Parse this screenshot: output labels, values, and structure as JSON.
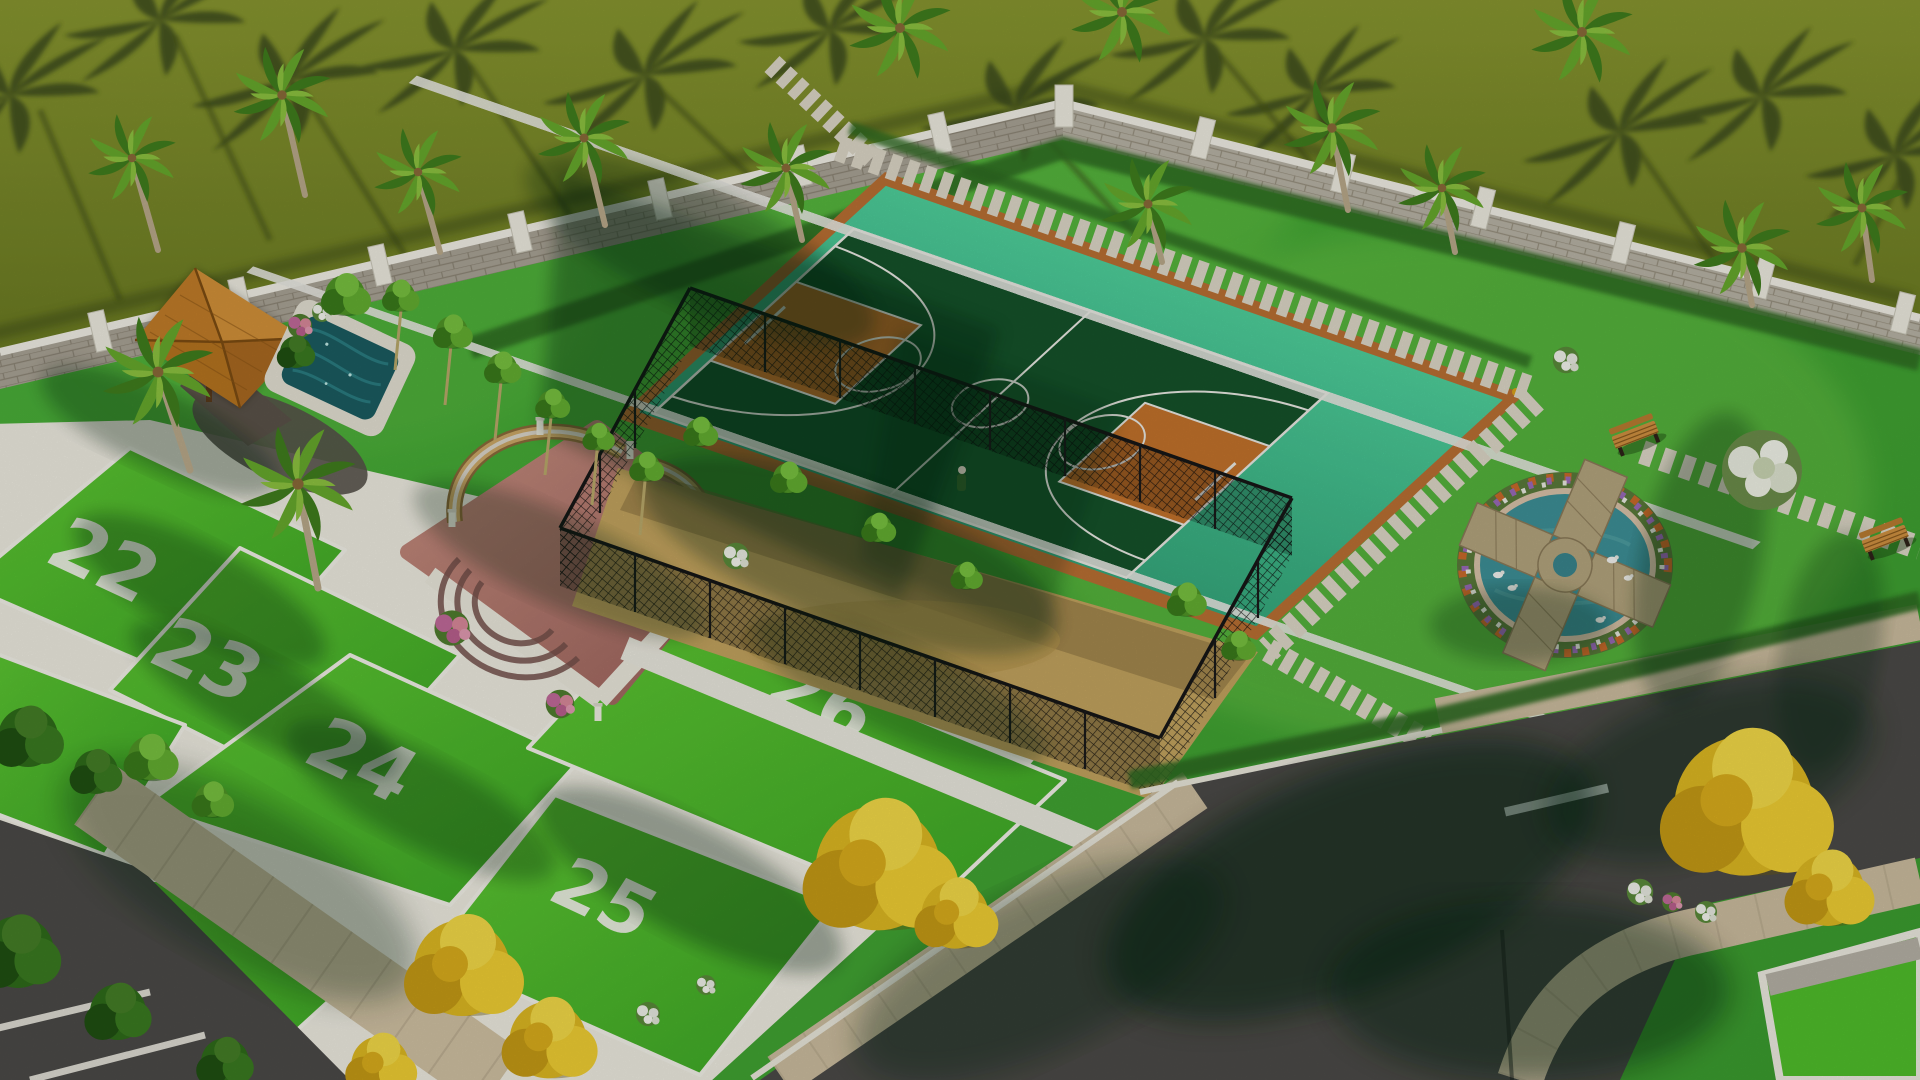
{
  "scene": {
    "title": "Aerial 3D render of gated residential plot layout",
    "plots": [
      {
        "label": "22"
      },
      {
        "label": "23"
      },
      {
        "label": "24"
      },
      {
        "label": "25"
      },
      {
        "label": "26"
      }
    ],
    "amenities": [
      "basketball-court",
      "fenced-sports-enclosure",
      "gazebo",
      "plunge-pool",
      "seating-plaza",
      "duck-pond",
      "garden-bench",
      "palm-lined-boundary-wall",
      "paver-walkways",
      "internal-roads"
    ],
    "colors": {
      "outer_lawn": "#7d8c2f",
      "inner_lawn": "#46a835",
      "plot_grass": "#4fbd2b",
      "plot_border": "#f1efe6",
      "court_apron": "#3fc08e",
      "court_surface": "#15522a",
      "court_key": "#c2722b",
      "court_border": "#b96f33",
      "court_lines": "#eef0ea",
      "wall_stone": "#b5b0a2",
      "wall_cap": "#efede4",
      "plaza_paving": "#bb7d72",
      "seat_wall": "#caa766",
      "gazebo_roof": "#c9842c",
      "pool_water": "#1d5f63",
      "pond_water": "#3d8f96",
      "pond_stone": "#b3a47d",
      "sand": "#c2a35e",
      "fence": "#1a1a1a",
      "walkway": "#dcd6c6",
      "sidewalk": "#cfc0a2",
      "asphalt": "#4b4a47",
      "tree_yellow": "#e3bd25",
      "tree_green": "#4f9426",
      "flower_pink": "#c06a9a"
    }
  }
}
